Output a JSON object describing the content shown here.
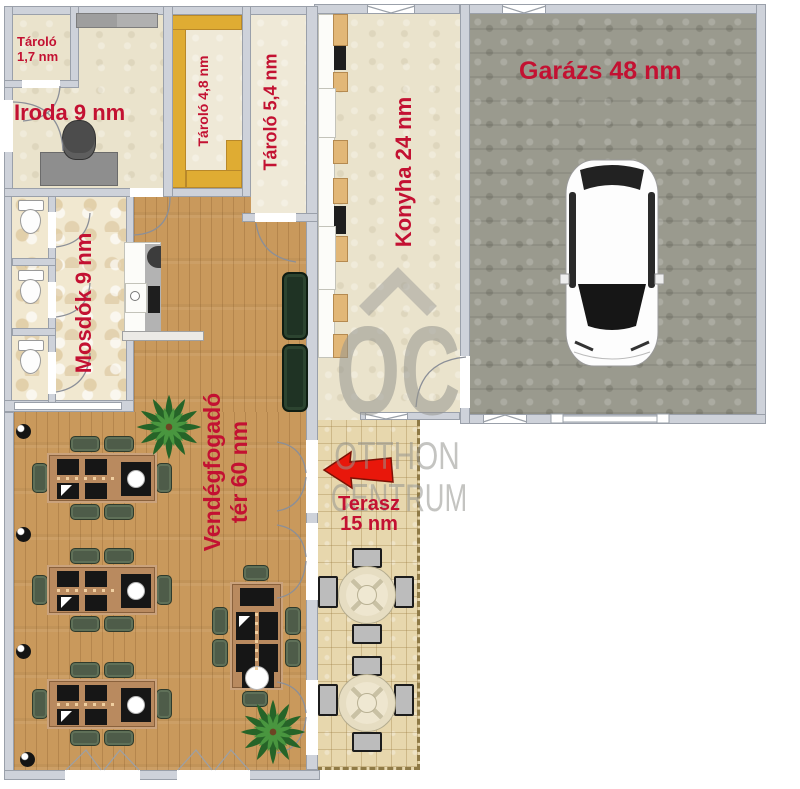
{
  "plan_title": "floor-plan",
  "colors": {
    "label": "#c31132",
    "arrow": "#e8170b",
    "watermark": "#95958f",
    "wall": "#ced2da",
    "wall_line": "#9aa0aa",
    "wood": "#c9995c",
    "tile": "#f1e8d0",
    "terrace": "#e7d7ad",
    "garage": "#9a9a8e",
    "beige": "#eae3cc",
    "beige_light": "#efe9d7",
    "yellow": "#dfac33",
    "chair_green": "#4e5c49",
    "sofa_green": "#1f3324",
    "table_brown": "#b98a5f"
  },
  "rooms": {
    "tarolo_small": {
      "line1": "Tároló",
      "line2": "1,7 nm"
    },
    "iroda": {
      "label": "Iroda 9 nm"
    },
    "tarolo_48": {
      "label": "Tároló 4,8 nm"
    },
    "tarolo_54": {
      "label": "Tároló 5,4 nm"
    },
    "konyha": {
      "label": "Konyha 24 nm"
    },
    "garazs": {
      "label": "Garázs 48 nm"
    },
    "mosdok": {
      "label": "Mosdók 9 nm"
    },
    "vendegfogado": {
      "line1": "Vendégfogadó",
      "line2": "tér 60 nm"
    },
    "terasz": {
      "line1": "Terasz",
      "line2": "15 nm"
    }
  },
  "watermark": {
    "logo": "OC",
    "name_top": "OTTHON",
    "name_bottom": "CENTRUM"
  }
}
